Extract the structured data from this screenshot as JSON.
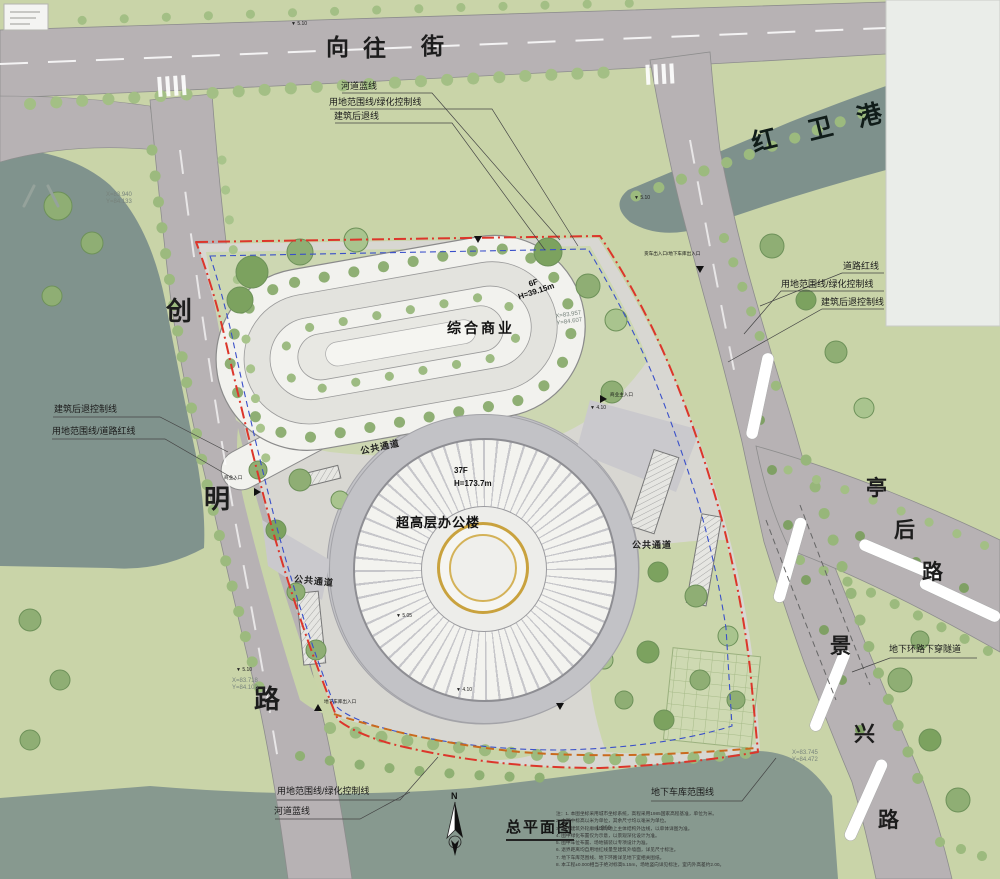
{
  "map": {
    "streets": {
      "xiangwang": {
        "chars": [
          "向",
          "往",
          "街"
        ]
      },
      "hongwei": {
        "chars": [
          "红",
          "卫",
          "港"
        ]
      },
      "chuangming": {
        "chars": [
          "创",
          "明",
          "路"
        ]
      },
      "tinghou": {
        "chars": [
          "亭",
          "后",
          "路"
        ]
      },
      "jingxing": {
        "chars": [
          "景",
          "兴",
          "路"
        ]
      }
    },
    "buildings": {
      "commercial": {
        "name": "综合商业",
        "floors": "6F",
        "height": "H=39.15m"
      },
      "tower": {
        "name": "超高层办公楼",
        "floors": "37F",
        "height": "H=173.7m"
      }
    },
    "passages": {
      "label": "公共通道"
    },
    "annotations": {
      "top": [
        "河道蓝线",
        "用地范围线/绿化控制线",
        "建筑后退线"
      ],
      "right": [
        "道路红线",
        "用地范围线/绿化控制线",
        "建筑后退控制线"
      ],
      "left": [
        "建筑后退控制线",
        "用地范围线/道路红线"
      ],
      "bottom_left": [
        "用地范围线/绿化控制线",
        "河道蓝线"
      ],
      "bottom": [
        "地下车库范围线"
      ],
      "east": [
        "地下环路下穿隧道"
      ]
    },
    "entrances": {
      "main_commercial": "商业主入口",
      "truck_garage": "货车出入口/地下车库出入口",
      "garage": "地下车库出入口",
      "commercial": "商业入口"
    },
    "coordinates": [
      {
        "x": "X=83.940",
        "y": "Y=84.133"
      },
      {
        "x": "X=83.957",
        "y": "Y=84.607"
      },
      {
        "x": "X=83.718",
        "y": "Y=84.103"
      },
      {
        "x": "X=83.745",
        "y": "Y=84.472"
      }
    ],
    "spot_elevations": [
      "5.10",
      "5.10",
      "4.10",
      "5.05",
      "5.10",
      "4.10"
    ]
  },
  "title_block": {
    "north": "N",
    "title": "总平面图",
    "scale": "1:800"
  },
  "notes": {
    "lines": [
      "注：1. 本图坐标采用城市坐标系统，高程采用1985国家高程基准，单位为米。",
      "2. 本图中标高以米为单位，其余尺寸均以毫米为单位。",
      "3. 图中建筑外轮廓线均为地上主体结构外边线，以单体详图为准。",
      "4. 图中绿化布置仅为示意，以景观深化设计为准。",
      "5. 图中车位布置、场地铺装以专项设计为准。",
      "6. 退界距离均自用地红线量至建筑外墙面，详见尺寸标注。",
      "7. 地下车库范围线、地下环路详见地下室相关图纸。",
      "8. 本工程±0.000相当于绝对标高5.15m，场地竖向详见标注，室内外高差约2.00。"
    ]
  },
  "colors": {
    "boundary_red": "#dc362b",
    "garage_blue": "#3a50c9",
    "setback_orange": "#c96a1e",
    "water": "#7e918c",
    "gold_ring": "#c9a23e"
  }
}
